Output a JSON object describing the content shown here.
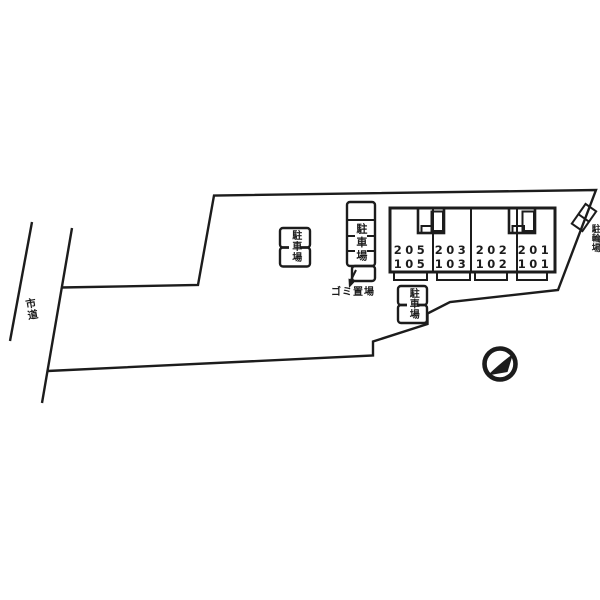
{
  "labels": {
    "road": "市道",
    "parking": "駐車場",
    "garbage": "ゴミ置場",
    "bicycle": "駐輪場"
  },
  "building": {
    "units": [
      {
        "upper": "205",
        "lower": "105"
      },
      {
        "upper": "203",
        "lower": "103"
      },
      {
        "upper": "202",
        "lower": "102"
      },
      {
        "upper": "201",
        "lower": "101"
      }
    ]
  },
  "colors": {
    "building_fill": "#f6f5cd",
    "line": "#1c1c1c"
  }
}
